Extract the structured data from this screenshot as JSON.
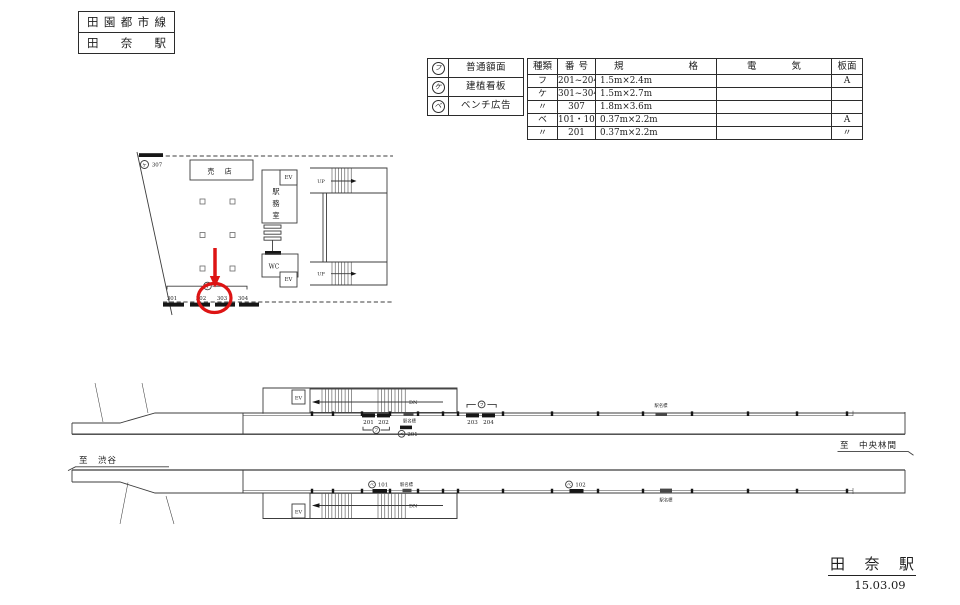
{
  "title_block": {
    "line_name": "田園都市線",
    "station_name": "田奈駅"
  },
  "legend": {
    "items": [
      {
        "symbol": "フ",
        "label": "普通額面"
      },
      {
        "symbol": "ケ",
        "label": "建植看板"
      },
      {
        "symbol": "ベ",
        "label": "ベンチ広告"
      }
    ]
  },
  "spec_table": {
    "headers": {
      "type": "種類",
      "number": "番号",
      "spec": "規格",
      "electric": "電気",
      "board": "板面"
    },
    "rows": [
      {
        "type": "フ",
        "number": "201~204",
        "spec": "1.5m×2.4m",
        "electric": "",
        "board": "A"
      },
      {
        "type": "ケ",
        "number": "301~304",
        "spec": "1.5m×2.7m",
        "electric": "",
        "board": ""
      },
      {
        "type": "〃",
        "number": "307",
        "spec": "1.8m×3.6m",
        "electric": "",
        "board": ""
      },
      {
        "type": "ベ",
        "number": "101・102",
        "spec": "0.37m×2.2m",
        "electric": "",
        "board": "A"
      },
      {
        "type": "〃",
        "number": "201",
        "spec": "0.37m×2.2m",
        "electric": "",
        "board": "〃"
      }
    ]
  },
  "plan": {
    "shop_label": "売 店",
    "office_chars": [
      "駅",
      "務",
      "室"
    ],
    "wc_label": "WC",
    "ev_label": "EV",
    "up_label": "UP",
    "sign_307_symbol": "ケ",
    "sign_307_number": "307",
    "bracket_symbol": "ケ",
    "ad_numbers": [
      "301",
      "302",
      "303",
      "304"
    ]
  },
  "upper_elevation": {
    "ev_label": "EV",
    "dn_label": "DN",
    "ad_labels": [
      "201",
      "202",
      "203",
      "204"
    ],
    "bracket_symbol": "フ",
    "bench_symbol": "ベ",
    "bench_number": "201",
    "sign_label": "駅名標",
    "direction_right": "至　中央林間"
  },
  "lower_elevation": {
    "ev_label": "EV",
    "dn_label": "DN",
    "bench_symbol": "ベ",
    "bench_numbers": [
      "101",
      "102"
    ],
    "sign_label": "駅名標",
    "direction_left": "至　渋谷"
  },
  "footer": {
    "station_name": "田奈駅",
    "date": "15.03.09"
  },
  "colors": {
    "line": "#3c3c3c",
    "accent_red": "#dd1414"
  }
}
